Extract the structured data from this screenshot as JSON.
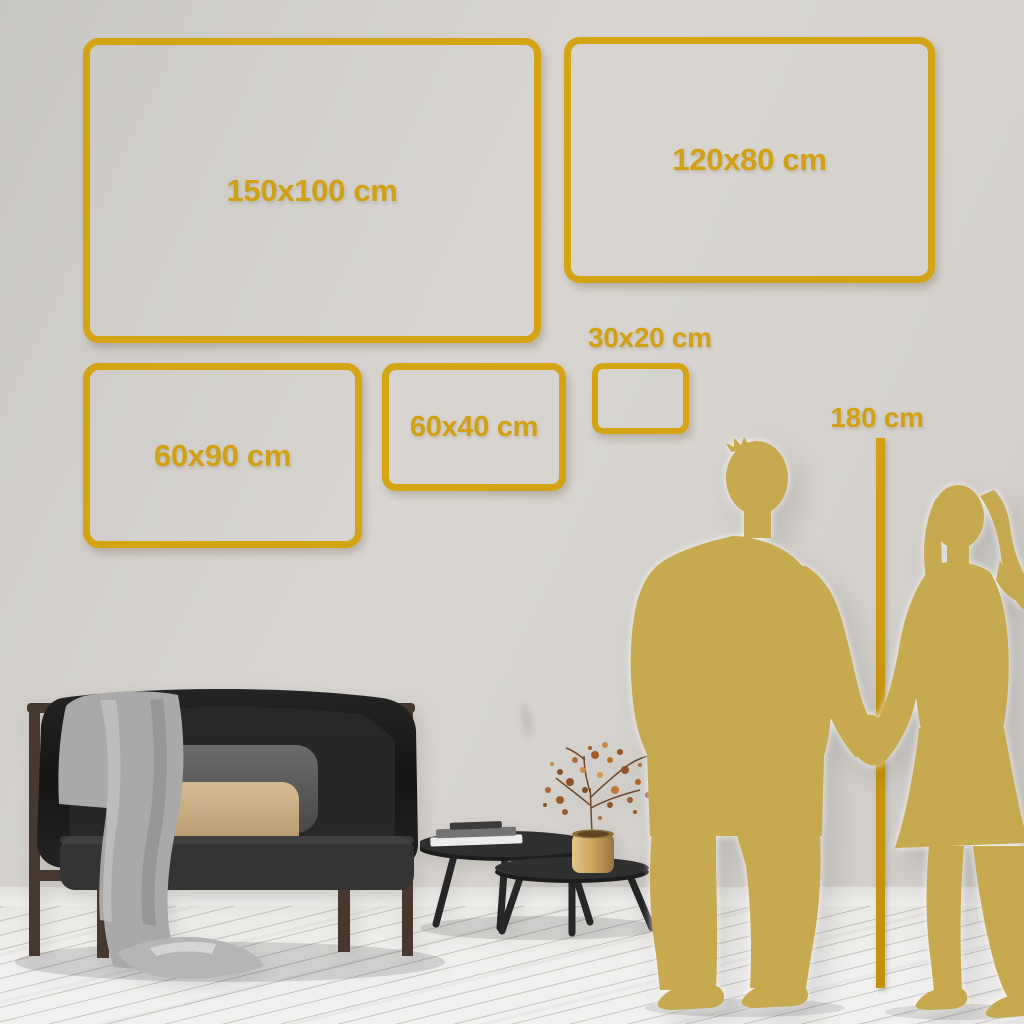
{
  "scene": {
    "kind": "wall-art-size-guide",
    "objects": [
      "gold-size-frames",
      "height-ruler",
      "couple-silhouette",
      "sofa",
      "blanket",
      "pillows",
      "nesting-coffee-tables",
      "books",
      "brass-vase",
      "dried-branch"
    ]
  },
  "colors": {
    "accent_gold": "#d4a414",
    "label_gold": "#d1a013",
    "ruler_gold": "#c9970e",
    "silhouette_gold": "#c7a94f",
    "wall": "#d4d1cc",
    "floor": "#eeedeb",
    "sofa_fabric": "#1e1e1e",
    "pillow_beige": "#c9ad85",
    "pillow_gray": "#5a5a5a",
    "blanket_gray": "#a9a9a9",
    "wood_frame": "#46382e",
    "table_wood": "#2b2b2b",
    "vase_brass": "#c9a86a",
    "berries": "#a4632f"
  },
  "frames": [
    {
      "id": "150x100",
      "label": "150x100 cm"
    },
    {
      "id": "120x80",
      "label": "120x80 cm"
    },
    {
      "id": "60x90",
      "label": "60x90 cm"
    },
    {
      "id": "60x40",
      "label": "60x40 cm"
    },
    {
      "id": "30x20",
      "label": "30x20 cm"
    }
  ],
  "height_ruler": {
    "label": "180 cm"
  }
}
